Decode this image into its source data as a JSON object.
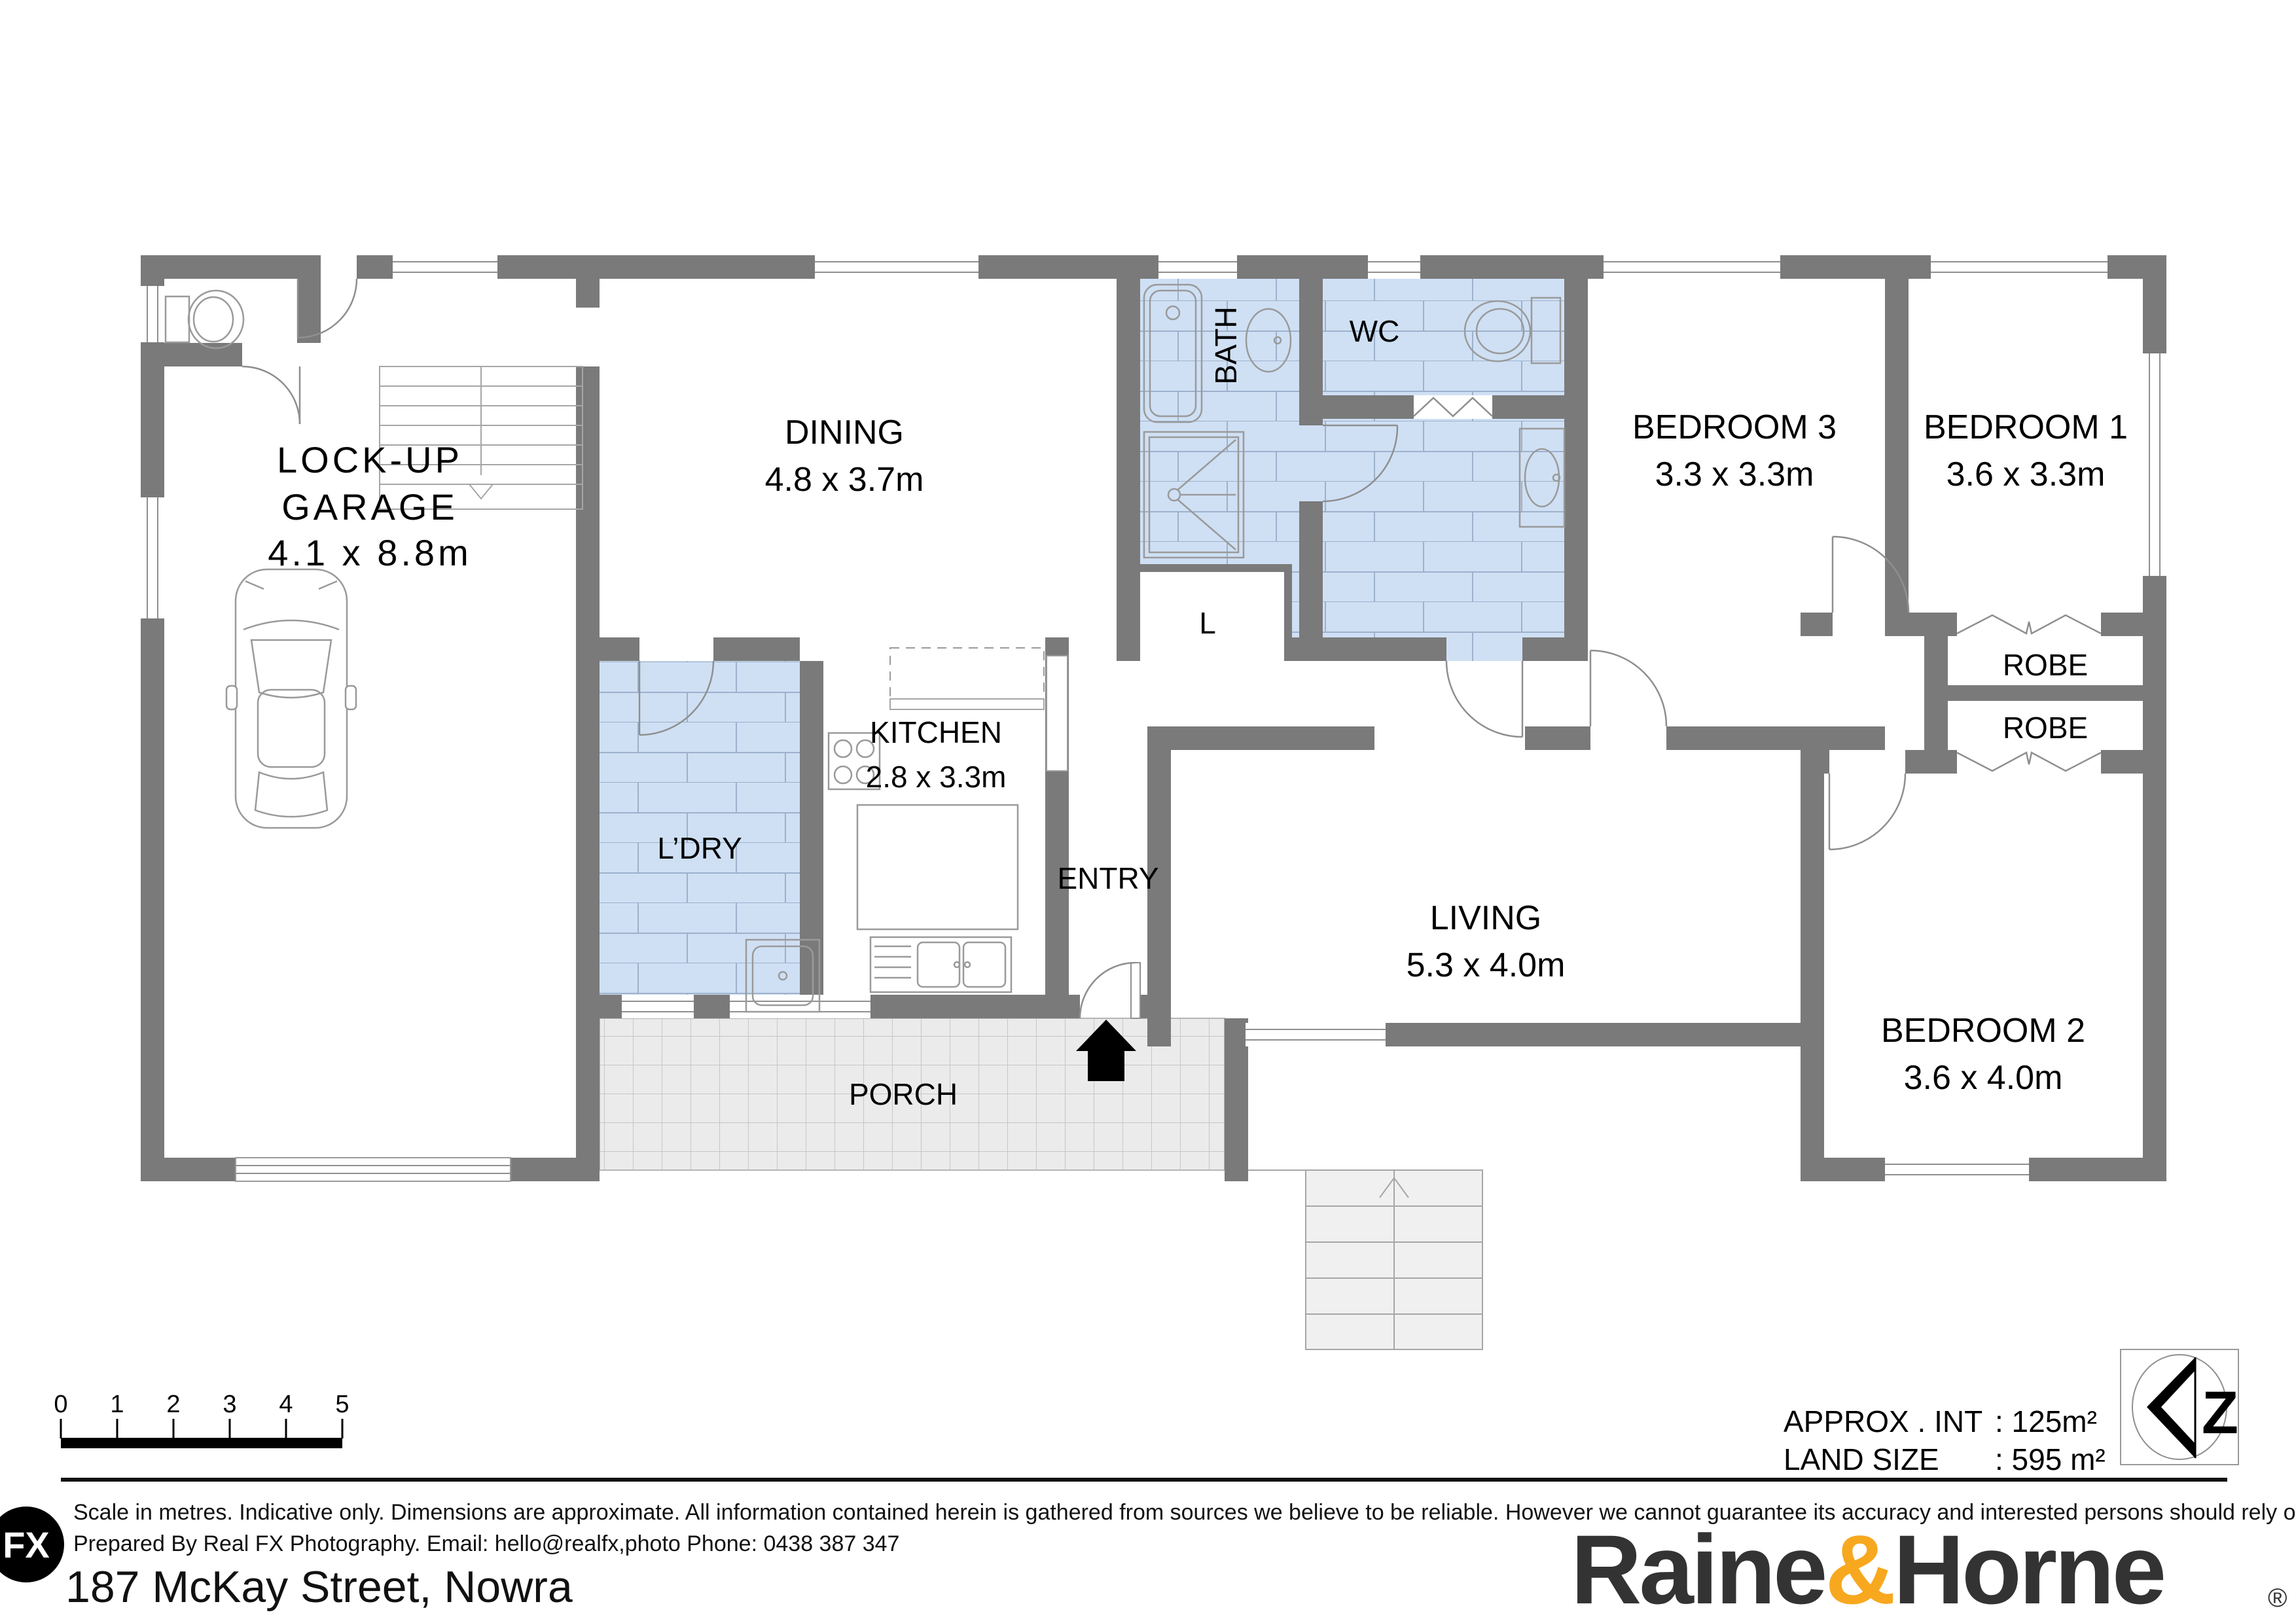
{
  "labels": {
    "garage_1": "LOCK-UP",
    "garage_2": "GARAGE",
    "garage_dims": "4.1 x 8.8m",
    "dining": "DINING",
    "dining_dims": "4.8 x 3.7m",
    "bath": "BATH",
    "wc": "WC",
    "linen": "L",
    "bed3": "BEDROOM 3",
    "bed3_dims": "3.3 x 3.3m",
    "bed1": "BEDROOM 1",
    "bed1_dims": "3.6 x 3.3m",
    "robe_top": "ROBE",
    "robe_bottom": "ROBE",
    "laundry": "L’DRY",
    "kitchen": "KITCHEN",
    "kitchen_dims": "2.8 x 3.3m",
    "entry": "ENTRY",
    "living": "LIVING",
    "living_dims": "5.3 x 4.0m",
    "bed2": "BEDROOM 2",
    "bed2_dims": "3.6 x 4.0m",
    "porch": "PORCH"
  },
  "scale_bar": {
    "ticks": [
      "0",
      "1",
      "2",
      "3",
      "4",
      "5"
    ]
  },
  "summary": {
    "approx_label": "APPROX . INT",
    "approx_value": ": 125m²",
    "land_label": "LAND SIZE",
    "land_value": ": 595 m²"
  },
  "compass": {
    "letter": "Z"
  },
  "footer": {
    "fx_logo": "FX",
    "disclaimer_1": "Scale in metres. Indicative only. Dimensions are approximate. All information contained herein is gathered from sources we believe to be reliable. However we cannot guarantee its accuracy and interested persons should rely on their own enquiries",
    "disclaimer_2": "Prepared By Real FX Photography. Email: hello@realfx,photo    Phone: 0438 387 347",
    "address": "187 McKay Street, Nowra"
  },
  "brand": {
    "part1": "Raine",
    "amp": "&",
    "part2": "Horne",
    "registered": "®",
    "accent_color": "#F7A81E",
    "text_color": "#333333"
  }
}
